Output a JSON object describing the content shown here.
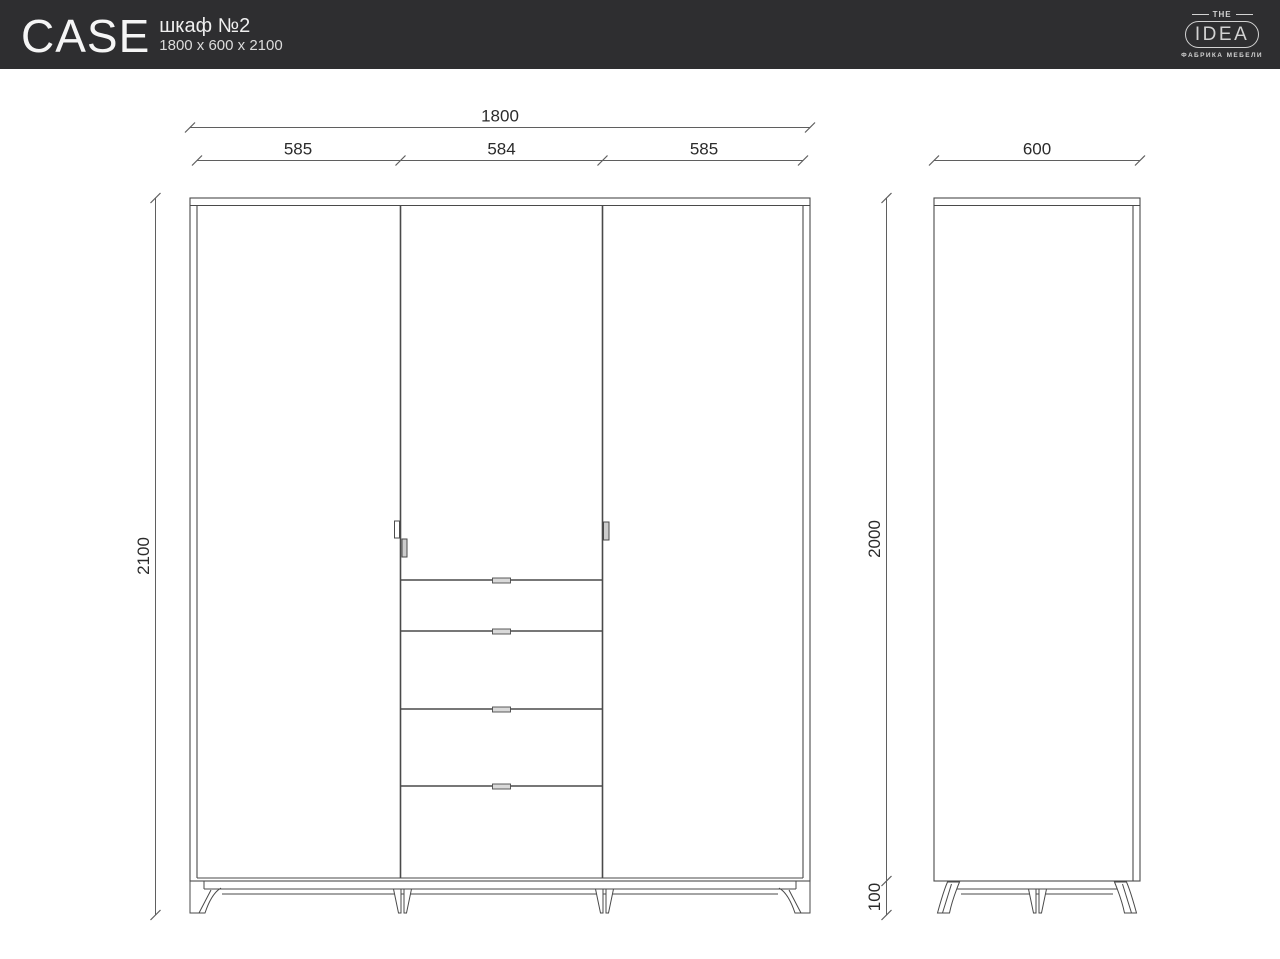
{
  "header": {
    "product_name": "CASE",
    "product_type": "шкаф №2",
    "product_size": "1800 x 600 x 2100"
  },
  "logo": {
    "top_text": "THE",
    "brand": "IDEA",
    "tagline": "ФАБРИКА МЕБЕЛИ"
  },
  "drawing": {
    "front_view": {
      "total_width": "1800",
      "left_door_width": "585",
      "middle_door_width": "584",
      "right_door_width": "585",
      "total_height": "2100"
    },
    "side_view": {
      "depth": "600",
      "body_height": "2000",
      "leg_height": "100"
    }
  },
  "colors": {
    "header_bg": "#2e2e30",
    "header_text": "#f5f5f5",
    "logo_color": "#d2d2d2",
    "outline_color": "#4a4a4a",
    "dimension_line_color": "#5f5f5f",
    "dimension_text_color": "#2b2b2b",
    "handle_fill": "#cccccc",
    "background": "#ffffff"
  }
}
